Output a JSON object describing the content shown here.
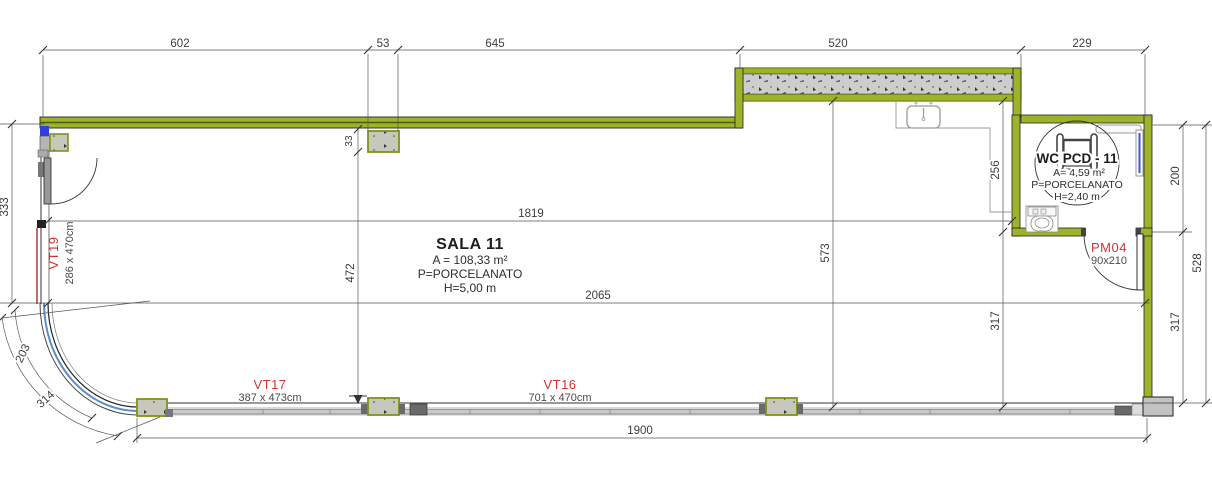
{
  "room": {
    "name": "SALA 11",
    "area": "A = 108,33 m²",
    "floor": "P=PORCELANATO",
    "height": "H=5,00 m"
  },
  "wc": {
    "name": "WC PCD - 11",
    "area": "A= 4,59 m²",
    "floor": "P=PORCELANATO",
    "height": "H=2,40 m"
  },
  "doors": {
    "pm04": {
      "code": "PM04",
      "size": "90x210"
    }
  },
  "windows": {
    "vt19": {
      "code": "VT19",
      "size": "286 x 470cm"
    },
    "vt17": {
      "code": "VT17",
      "size": "387 x 473cm"
    },
    "vt16": {
      "code": "VT16",
      "size": "701 x 470cm"
    }
  },
  "dims": {
    "top": [
      "602",
      "53",
      "645",
      "520",
      "229"
    ],
    "left_333": "333",
    "col_33": "33",
    "v472": "472",
    "v573": "573",
    "v256": "256",
    "v317_wc": "317",
    "h1819": "1819",
    "h2065": "2065",
    "h1900": "1900",
    "right_200": "200",
    "right_317": "317",
    "right_528": "528",
    "arc_203": "203",
    "arc_314": "314"
  },
  "colors": {
    "wall_green": "#9fb32a",
    "wall_green_dark": "#47610a",
    "concrete": "#cdcdcd",
    "glass_blue": "#5b8ec9",
    "label_red": "#d23232",
    "accent_blue": "#2f3fd8"
  }
}
